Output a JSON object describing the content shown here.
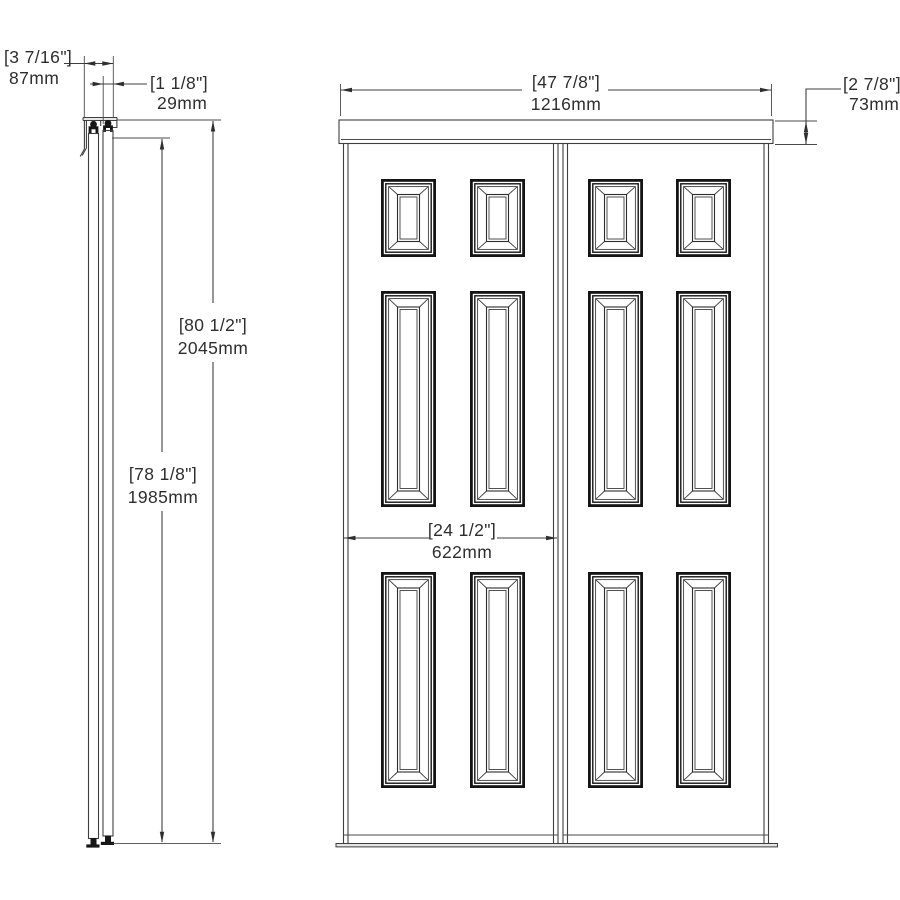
{
  "drawing": {
    "dims": {
      "overall_depth": {
        "inches": "[3 7/16\"]",
        "mm": "87mm"
      },
      "door_thickness": {
        "inches": "[1 1/8\"]",
        "mm": "29mm"
      },
      "overall_height": {
        "inches": "[80 1/2\"]",
        "mm": "2045mm"
      },
      "door_height": {
        "inches": "[78 1/8\"]",
        "mm": "1985mm"
      },
      "overall_width": {
        "inches": "[47 7/8\"]",
        "mm": "1216mm"
      },
      "track_height": {
        "inches": "[2 7/8\"]",
        "mm": "73mm"
      },
      "door_width": {
        "inches": "[24 1/2\"]",
        "mm": "622mm"
      }
    },
    "colors": {
      "line": "#3f3f3f",
      "panel_frame": "#141414",
      "text": "#2e2e2e",
      "background": "#ffffff"
    }
  }
}
